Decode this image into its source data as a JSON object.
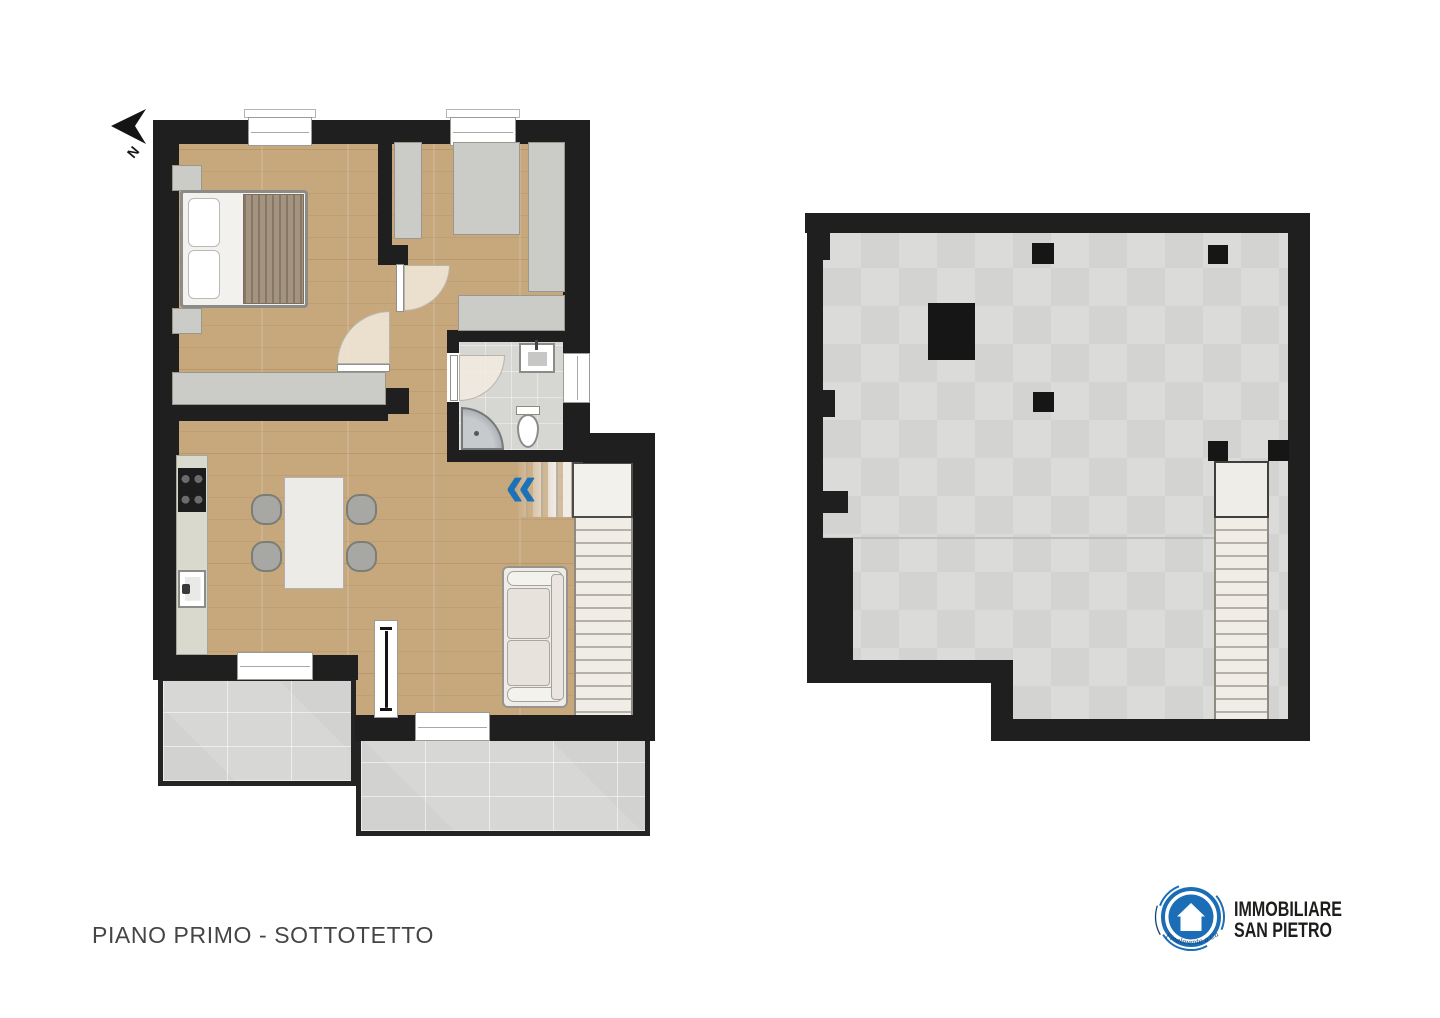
{
  "title": {
    "label": "PIANO PRIMO - SOTTOTETTO"
  },
  "compass": {
    "label": "N"
  },
  "branding": {
    "name_line1": "IMMOBILIARE",
    "name_line2": "SAN PIETRO",
    "tagline": "Finalmente a Casa"
  },
  "icons": {
    "north_arrow_icon": "left-pointing-dart",
    "stairs_direction_icon": "«"
  },
  "colors": {
    "wall": "#1f1f1f",
    "wood": "#c7a87d",
    "tile": "#d7d7d5",
    "attic": "#dbdbd9",
    "accent": "#1b72b8",
    "logoBlue": "#1b6db6",
    "textDark": "#454545"
  }
}
